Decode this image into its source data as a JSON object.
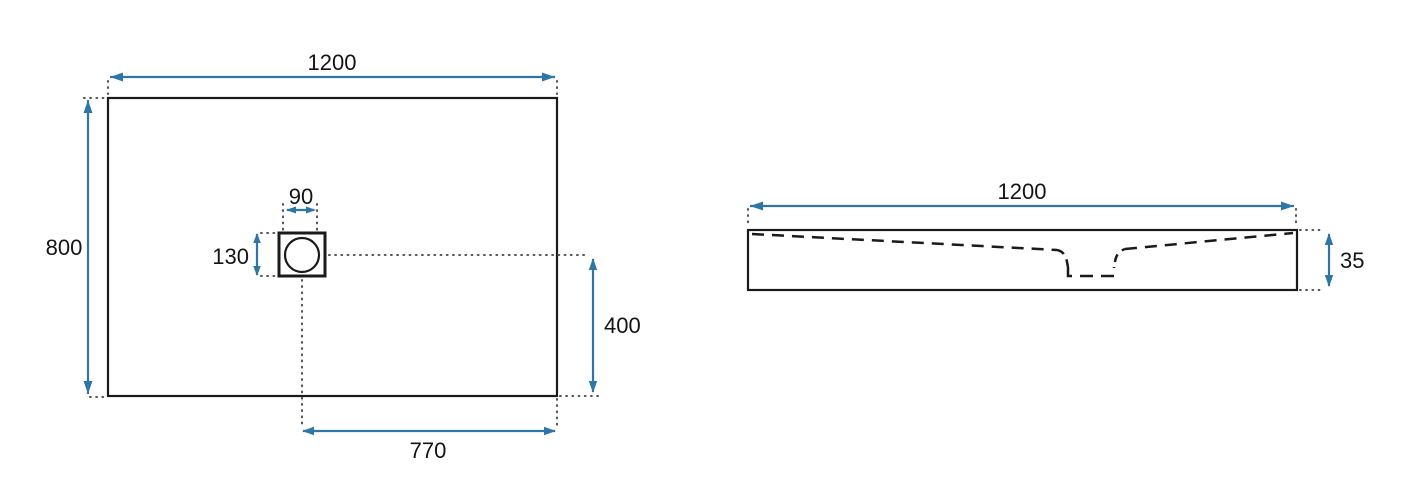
{
  "colors": {
    "dimension_blue": "#2e76a6",
    "outline_black": "#1a1a1a",
    "dot_gray": "#555555",
    "background": "#ffffff"
  },
  "top_view": {
    "width_mm": "1200",
    "depth_mm": "800",
    "drain_width_mm": "90",
    "drain_height_mm": "130",
    "drain_offset_bottom_mm": "400",
    "drain_offset_right_mm": "770"
  },
  "side_view": {
    "width_mm": "1200",
    "height_mm": "35"
  }
}
